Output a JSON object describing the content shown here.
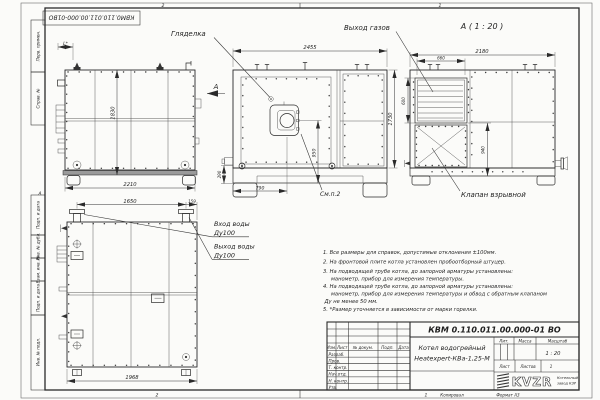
{
  "colors": {
    "ink": "#1f1f1f",
    "paper": "#fbfbf9",
    "line": "#2a2a2a"
  },
  "sheet": {
    "stamp_top_left": "КВМ0.110.011.00.000-01ВО",
    "zones": {
      "top_left": "2",
      "top_right": "1",
      "bottom_left": "2",
      "bottom_right": "1",
      "left_middle": "А"
    },
    "margin_columns": {
      "perv_primen": "Перв. примен.",
      "sprav_no": "Справ. №",
      "podp_data_1": "Подп. и дата",
      "inv_no_dubl": "Инв. № дубл.",
      "vzam_inv_no": "Взам. инв. №",
      "podp_data_2": "Подп. и дата",
      "inv_no_podl": "Инв. № подл."
    },
    "footer": {
      "kopiroval": "Копировал",
      "format": "Формат А3"
    }
  },
  "views": {
    "side": {
      "dim_burner": "L*",
      "dim_height": "1830",
      "dim_depth": "2210",
      "view_arrow_label": "А"
    },
    "front": {
      "label_sight_glass": "Гляделка",
      "label_see_note": "См.п.2",
      "dim_width": "2455",
      "dim_height": "1730",
      "dim_burner_axis": "950",
      "dim_burner_offset": "790",
      "dim_base": "290"
    },
    "view_a": {
      "title": "А ( 1 : 20 )",
      "label_gas_outlet": "Выход газов",
      "label_explosion_valve": "Клапан взрывной",
      "dim_width": "2180",
      "dim_grille_width": "660",
      "dim_grille_height": "600",
      "dim_valve_height": "940"
    },
    "top": {
      "dim_pipe_spacing": "1650",
      "dim_pipe_edge": "159",
      "dim_width": "1968",
      "label_water_in": "Вход воды",
      "label_water_in_dn": "Ду100",
      "label_water_out": "Выход воды",
      "label_water_out_dn": "Ду100"
    }
  },
  "notes": {
    "lines": [
      "1. Все размеры для справок, допустимые отклонения ±100мм.",
      "2. На фронтовой плите котла установлен пробоотборный штуцер.",
      "3. На подводящей трубе котла, до запорной арматуры установлены:",
      "манометр, прибор для измерения температуры.",
      "4. На подводящей трубе котла, до запорной арматуры установлены:",
      "манометр, прибор для измерения температуры и обвод с обратным клапаном",
      "Ду не менее 50 мм.",
      "5. *Размер уточняется в зависимости от марки горелки."
    ]
  },
  "title_block": {
    "doc_number": "КВМ 0.110.011.00.000-01 ВО",
    "product_name_1": "Котел водогрейный",
    "product_name_2": "Heatexpert-КВа-1,25-М",
    "cols": {
      "izm": "Изм.",
      "list": "Лист",
      "doc": "№ докум.",
      "podp": "Подп.",
      "data": "Дата"
    },
    "rows": {
      "razrab": "Разраб.",
      "prov": "Пров.",
      "tkontr": "Т. контр.",
      "nachotd": "Нач.отд.",
      "nkontr": "Н. контр.",
      "utv": "Утв."
    },
    "lit": "Лит.",
    "massa": "Масса",
    "masshtab": "Масштаб",
    "scale_value": "1 : 20",
    "list_label": "Лист",
    "listov_label": "Листов",
    "listov_value": "1",
    "logo": "KVZR",
    "logo_sub_1": "Котельный",
    "logo_sub_2": "завод КЗР"
  }
}
